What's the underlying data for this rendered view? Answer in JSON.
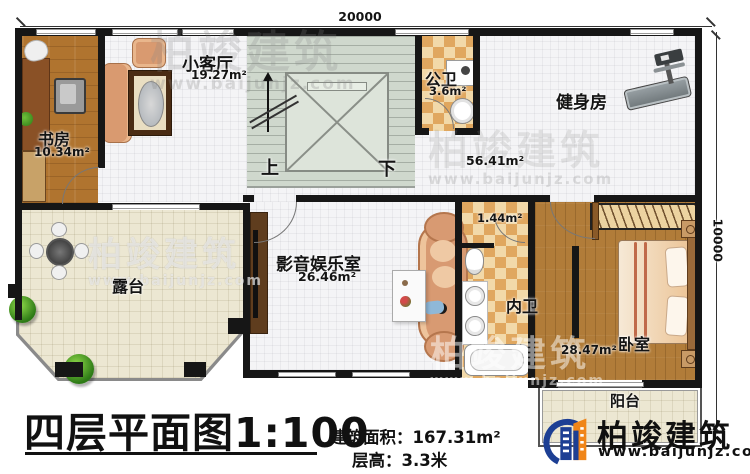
{
  "plan": {
    "dimensions": {
      "top_width": "20000",
      "right_height": "10000"
    },
    "rooms": {
      "study": {
        "name": "书房",
        "area": "10.34m²"
      },
      "small_living": {
        "name": "小客厅",
        "area": "19.27m²"
      },
      "public_bath": {
        "name": "公卫",
        "area": "3.6m²"
      },
      "gym": {
        "name": "健身房",
        "area": "56.41m²"
      },
      "terrace": {
        "name": "露台"
      },
      "media_room": {
        "name": "影音娱乐室",
        "area": "26.46m²"
      },
      "closet": {
        "area": "1.44m²"
      },
      "ensuite_bath": {
        "name": "内卫"
      },
      "bedroom": {
        "name": "卧室",
        "area": "28.47m²"
      },
      "balcony": {
        "name": "阳台"
      }
    },
    "stairs": {
      "up_label": "上",
      "down_label": "下"
    }
  },
  "title_block": {
    "title": "四层平面图1:100",
    "building_area": "建筑面积：167.31m²",
    "floor_height": "层高：3.3米"
  },
  "brand": {
    "name": "柏竣建筑",
    "website": "www.baijunjz.com"
  },
  "watermark": {
    "name": "柏竣建筑",
    "website": "www.baijunjz.com"
  },
  "colors": {
    "wall": "#161616",
    "wood_floor": "#b0742f",
    "cream_tile": "#ece7d2",
    "checker_tan": "#e0a75f",
    "stair_green": "#cfd8cd",
    "logo_blue": "#1d3f94",
    "logo_orange": "#f08519"
  }
}
